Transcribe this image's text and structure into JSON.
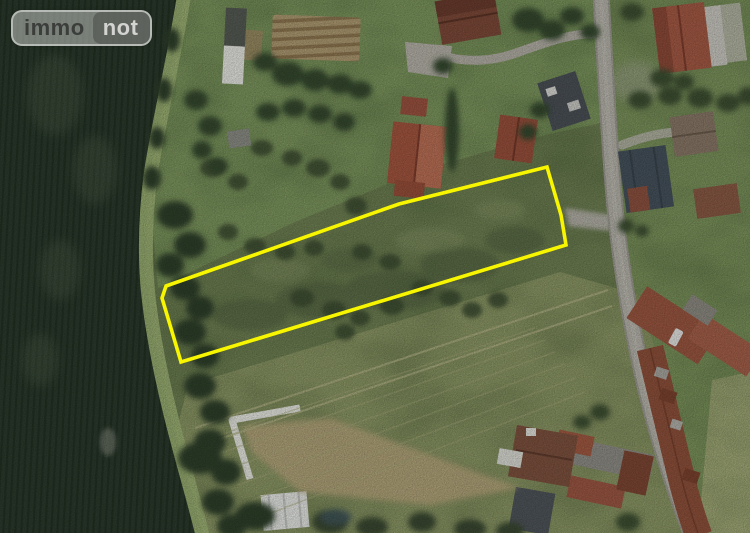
{
  "logo": {
    "left": "immo",
    "right": "not"
  },
  "parcel": {
    "points": "166,286 399,204 547,167 561,215 566,245 181,362 162,298",
    "outline_color": "#f8f500",
    "outline_width": "3.6"
  },
  "scene": {
    "colors": {
      "dark_crop_field": "#2b3a2d",
      "grass_margin": "#9db274",
      "meadow": "#6f8153",
      "lawn": "#7c965e",
      "bottom_meadow": "#8b9765",
      "road": "#b6b4ab",
      "roof_red": "#a3563f",
      "roof_slate": "#46525c",
      "white_structure": "#e6e6e1",
      "bare_earth": "#b9a77e"
    }
  }
}
